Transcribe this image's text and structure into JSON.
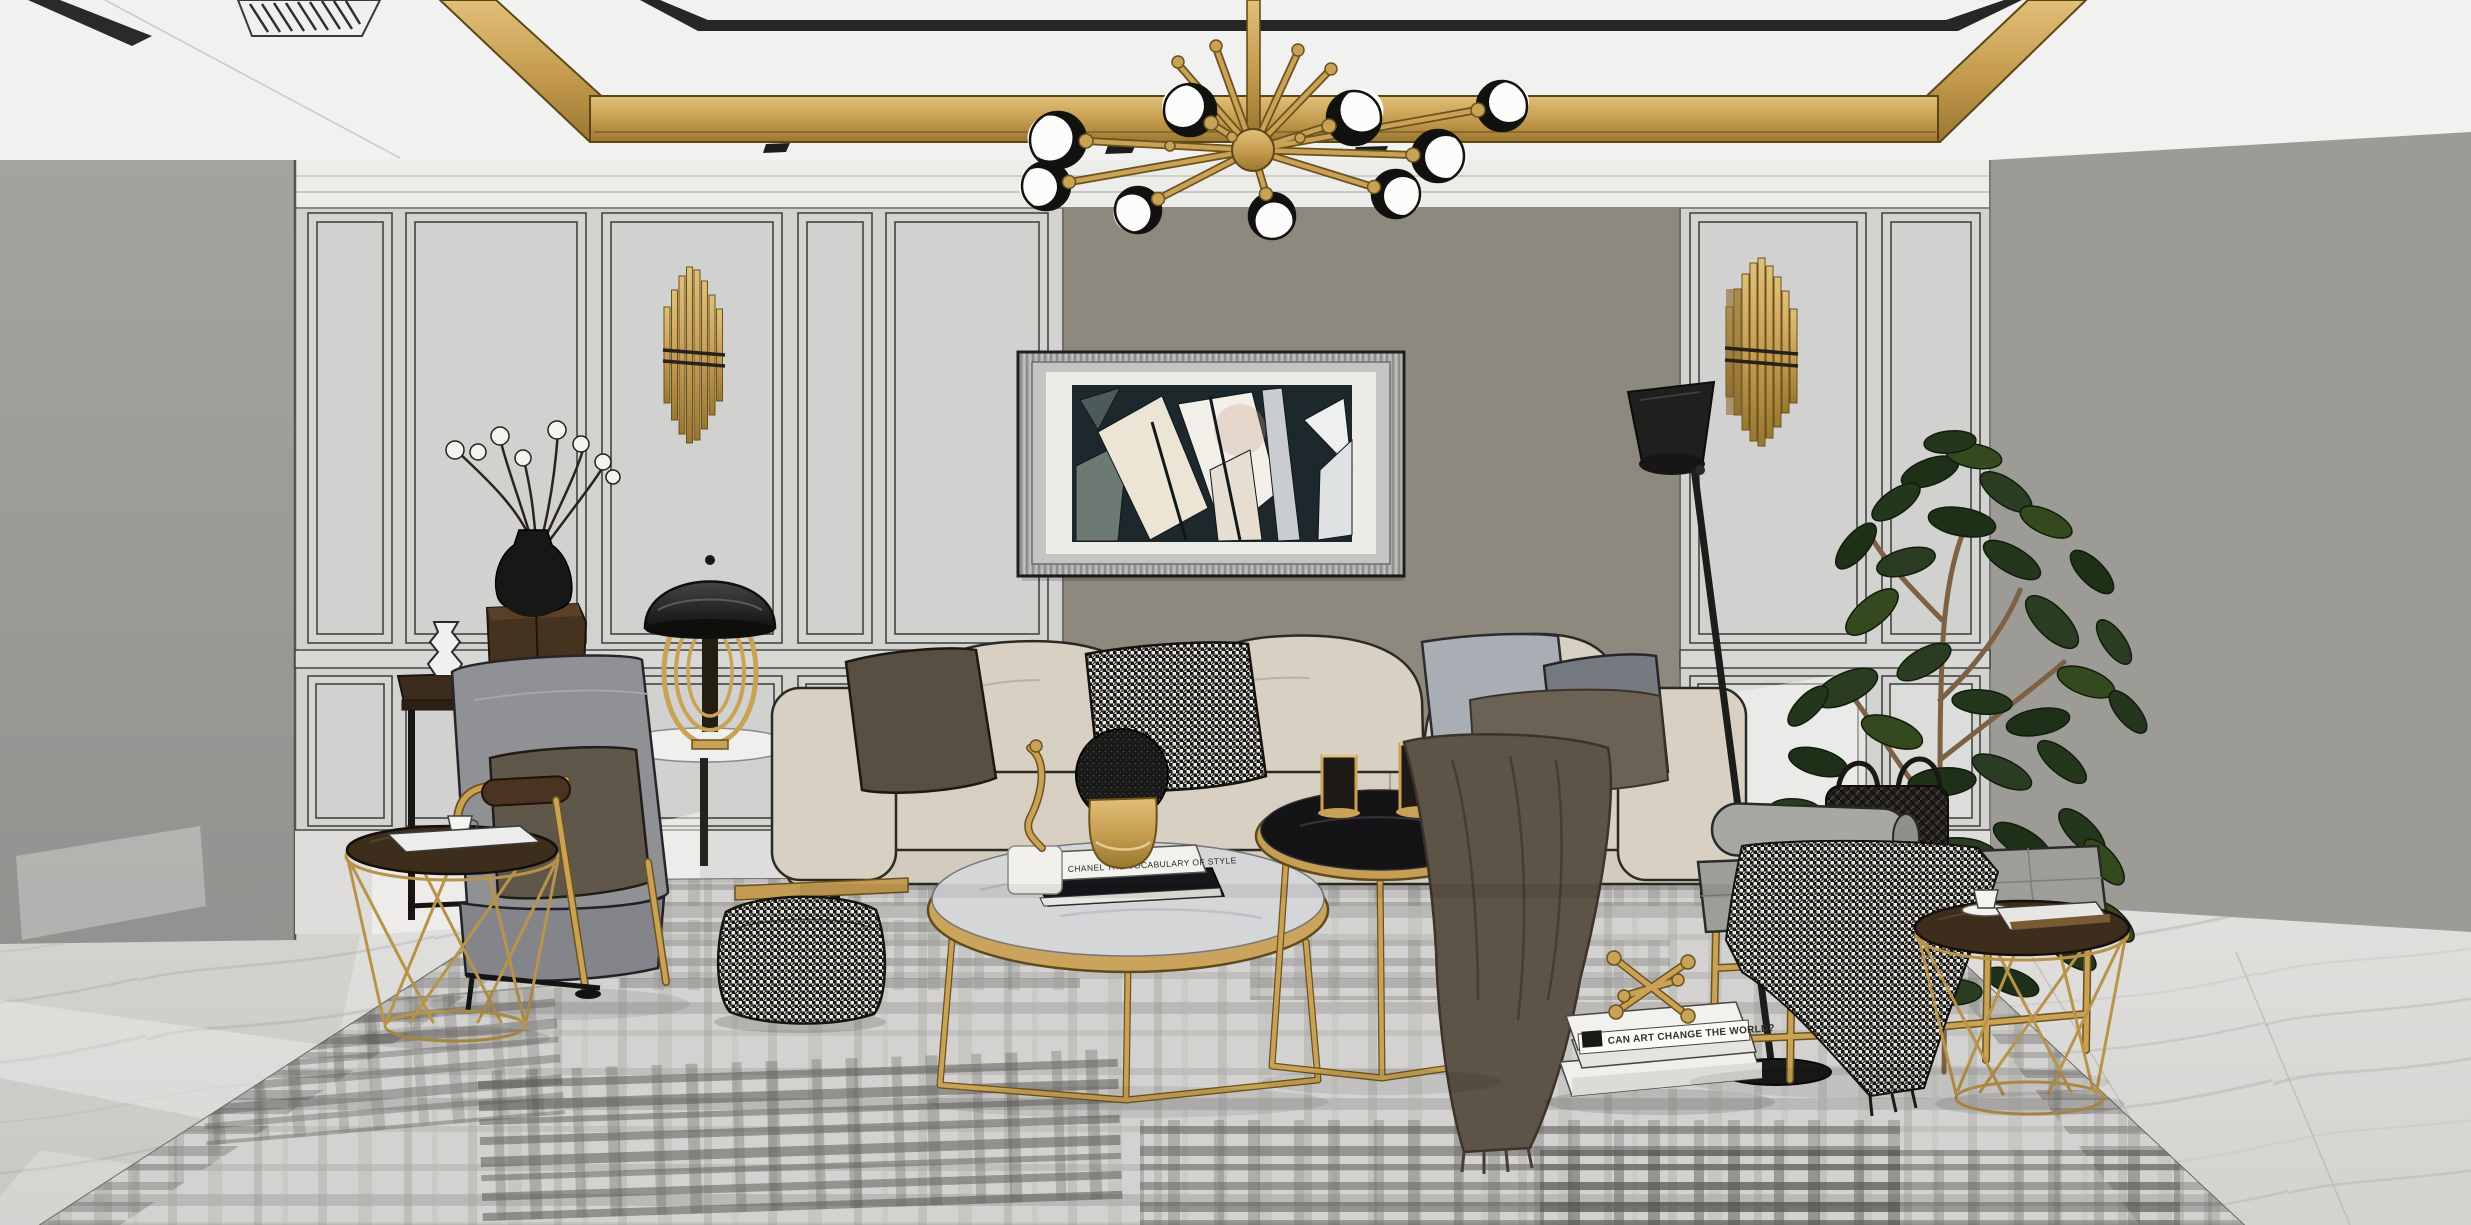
{
  "scene": {
    "description": "Stylized 3D rendered living room interior, light-luxury style with ink outlines",
    "room_type": "living room",
    "render_style": "sketch-render with black contour lines"
  },
  "palette": {
    "gold": "#c49b52",
    "ceiling_white": "#f1f1ef",
    "wall_panel_gray": "#d2d2d0",
    "accent_wall_taupe": "#8e897e",
    "side_wall_gray": "#9d9b96",
    "left_wall_gray": "#a09e99",
    "sofa_beige": "#d8d1c3",
    "chair_gray": "#909195",
    "floor_marble": "#dcdbd9",
    "rug_gray": "#d3d2d0",
    "plant_green": "#2c4026",
    "lamp_black": "#1e1e1c",
    "wood_dark": "#3c2d1d"
  },
  "decor": {
    "books": {
      "coffee_table_book_title": "CHANEL  THE VOCABULARY OF STYLE",
      "floor_book_title": "CAN ART CHANGE THE WORLD?"
    },
    "counts": {
      "chandelier_bulbs": 9,
      "wall_sconces": 2,
      "coffee_tables": 2,
      "wire_side_tables": 2,
      "sofa_accent_pillows": 4,
      "cotton_branch_balls": 8
    }
  },
  "inventory": [
    "gold sputnik chandelier",
    "gold ceiling trim band",
    "black ceiling trim",
    "linear ac vent",
    "wainscot paneled walls",
    "taupe fabric accent wall",
    "abstract framed artwork",
    "art deco gold tube sconce left",
    "art deco gold tube sconce right",
    "beige three seat sofa",
    "brown pillow",
    "houndstooth pillow",
    "gray pillows",
    "gray lounge armchair with gold frame",
    "dark wood console table",
    "black round vase with cotton branches",
    "white corrugated vase",
    "dark wood box",
    "black dome table lamp with gold rings",
    "white round side table",
    "gold wire basket side table left",
    "gold wire basket side table right",
    "round marble coffee table gold",
    "round black marble nesting table",
    "gold abstract figurine",
    "gold vase with black moss ball",
    "gold candle holders",
    "houndstooth pouf",
    "brown throw blanket",
    "houndstooth throw",
    "gray tufted bench with gold frame",
    "black wicker basket",
    "black floor lamp",
    "potted rubber fig plant",
    "stacked books on floor",
    "gold jack ornament",
    "coffee cups",
    "gray plaid area rug",
    "white marble floor"
  ]
}
